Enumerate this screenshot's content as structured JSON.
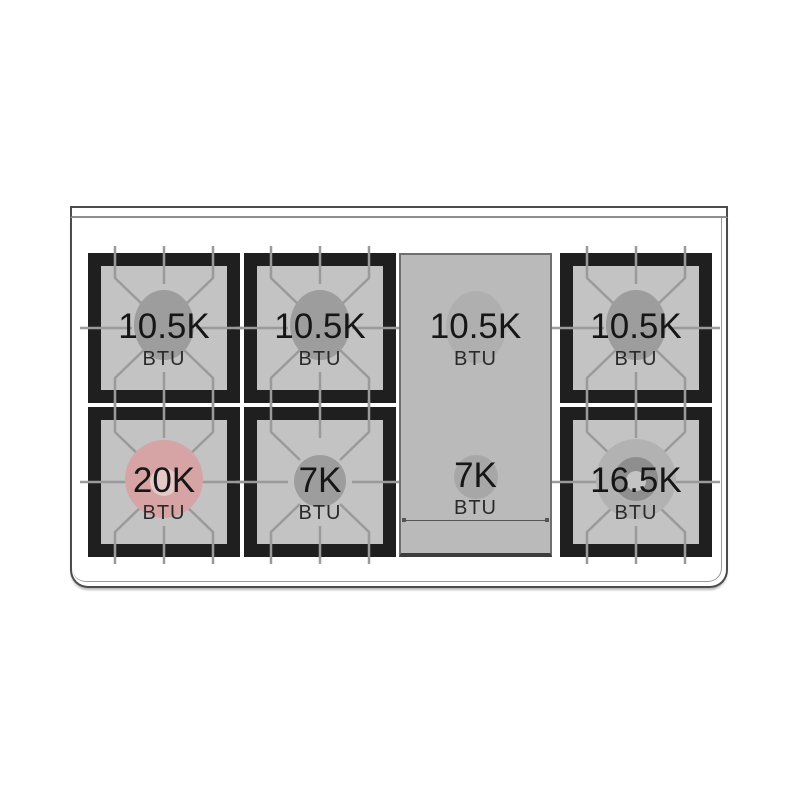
{
  "figure": {
    "name": "Gas range cooktop burner layout diagram",
    "rows": 2,
    "columns": 4
  },
  "burners": [
    {
      "position": "rear-left",
      "value": "10.5K",
      "unit": "BTU",
      "style": "single"
    },
    {
      "position": "rear-center-left",
      "value": "10.5K",
      "unit": "BTU",
      "style": "single"
    },
    {
      "position": "griddle-rear",
      "value": "10.5K",
      "unit": "BTU",
      "style": "griddle"
    },
    {
      "position": "rear-right",
      "value": "10.5K",
      "unit": "BTU",
      "style": "single"
    },
    {
      "position": "front-left",
      "value": "20K",
      "unit": "BTU",
      "style": "power-ring"
    },
    {
      "position": "front-center-left",
      "value": "7K",
      "unit": "BTU",
      "style": "single-small"
    },
    {
      "position": "griddle-front",
      "value": "7K",
      "unit": "BTU",
      "style": "griddle"
    },
    {
      "position": "front-right",
      "value": "16.5K",
      "unit": "BTU",
      "style": "dual-ring"
    }
  ],
  "colors": {
    "frame-black": "#1f1f1f",
    "grate-bg": "#c3c3c3",
    "grate-line": "#9a9a9a",
    "burner-gray": "#9d9d9d",
    "power-pink": "#d6a4a4",
    "power-pink-center": "#e5c9c9",
    "ring-outer": "#b2b2b2",
    "ring-mid": "#8e8e8e",
    "ring-center": "#c4c4c4",
    "griddle-bg": "#bababa",
    "griddle-circle": "#afafaf",
    "griddle-circle-small": "#a7a7a7",
    "outline": "#4c4c4c",
    "text": "#161616"
  }
}
